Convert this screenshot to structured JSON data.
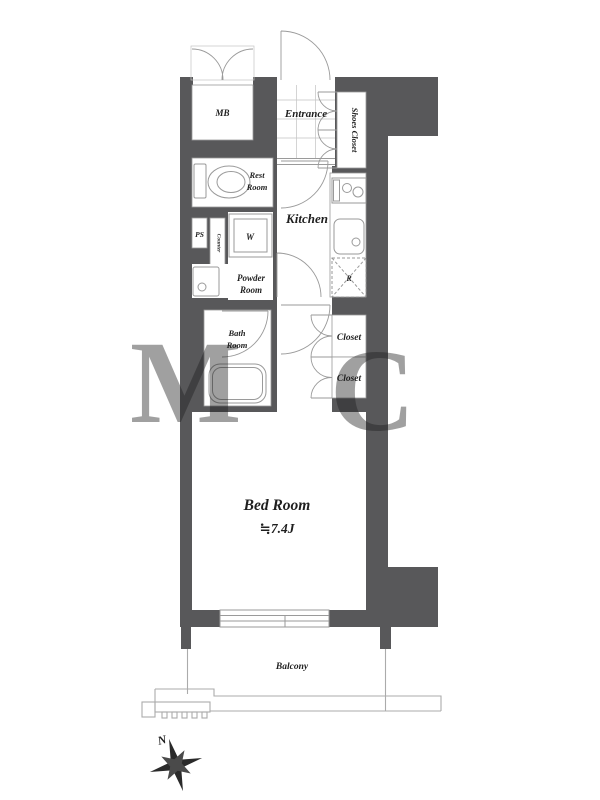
{
  "plan": {
    "rooms": {
      "mb": "MB",
      "entrance": "Entrance",
      "shoes_closet": "Shoes Closet",
      "rest_room_line1": "Rest",
      "rest_room_line2": "Room",
      "ps": "PS",
      "counter": "Counter",
      "washer": "W",
      "kitchen": "Kitchen",
      "refrigerator": "R",
      "powder_room_line1": "Powder",
      "powder_room_line2": "Room",
      "bath_room_line1": "Bath",
      "bath_room_line2": "Room",
      "closet_upper": "Closet",
      "closet_lower": "Closet",
      "bed_room": "Bed Room",
      "bed_room_size": "≒7.4J",
      "balcony": "Balcony"
    },
    "compass": {
      "north": "N"
    },
    "colors": {
      "wall": "#58585a",
      "line": "#9a9a9a",
      "text": "#1f1f1f"
    }
  }
}
